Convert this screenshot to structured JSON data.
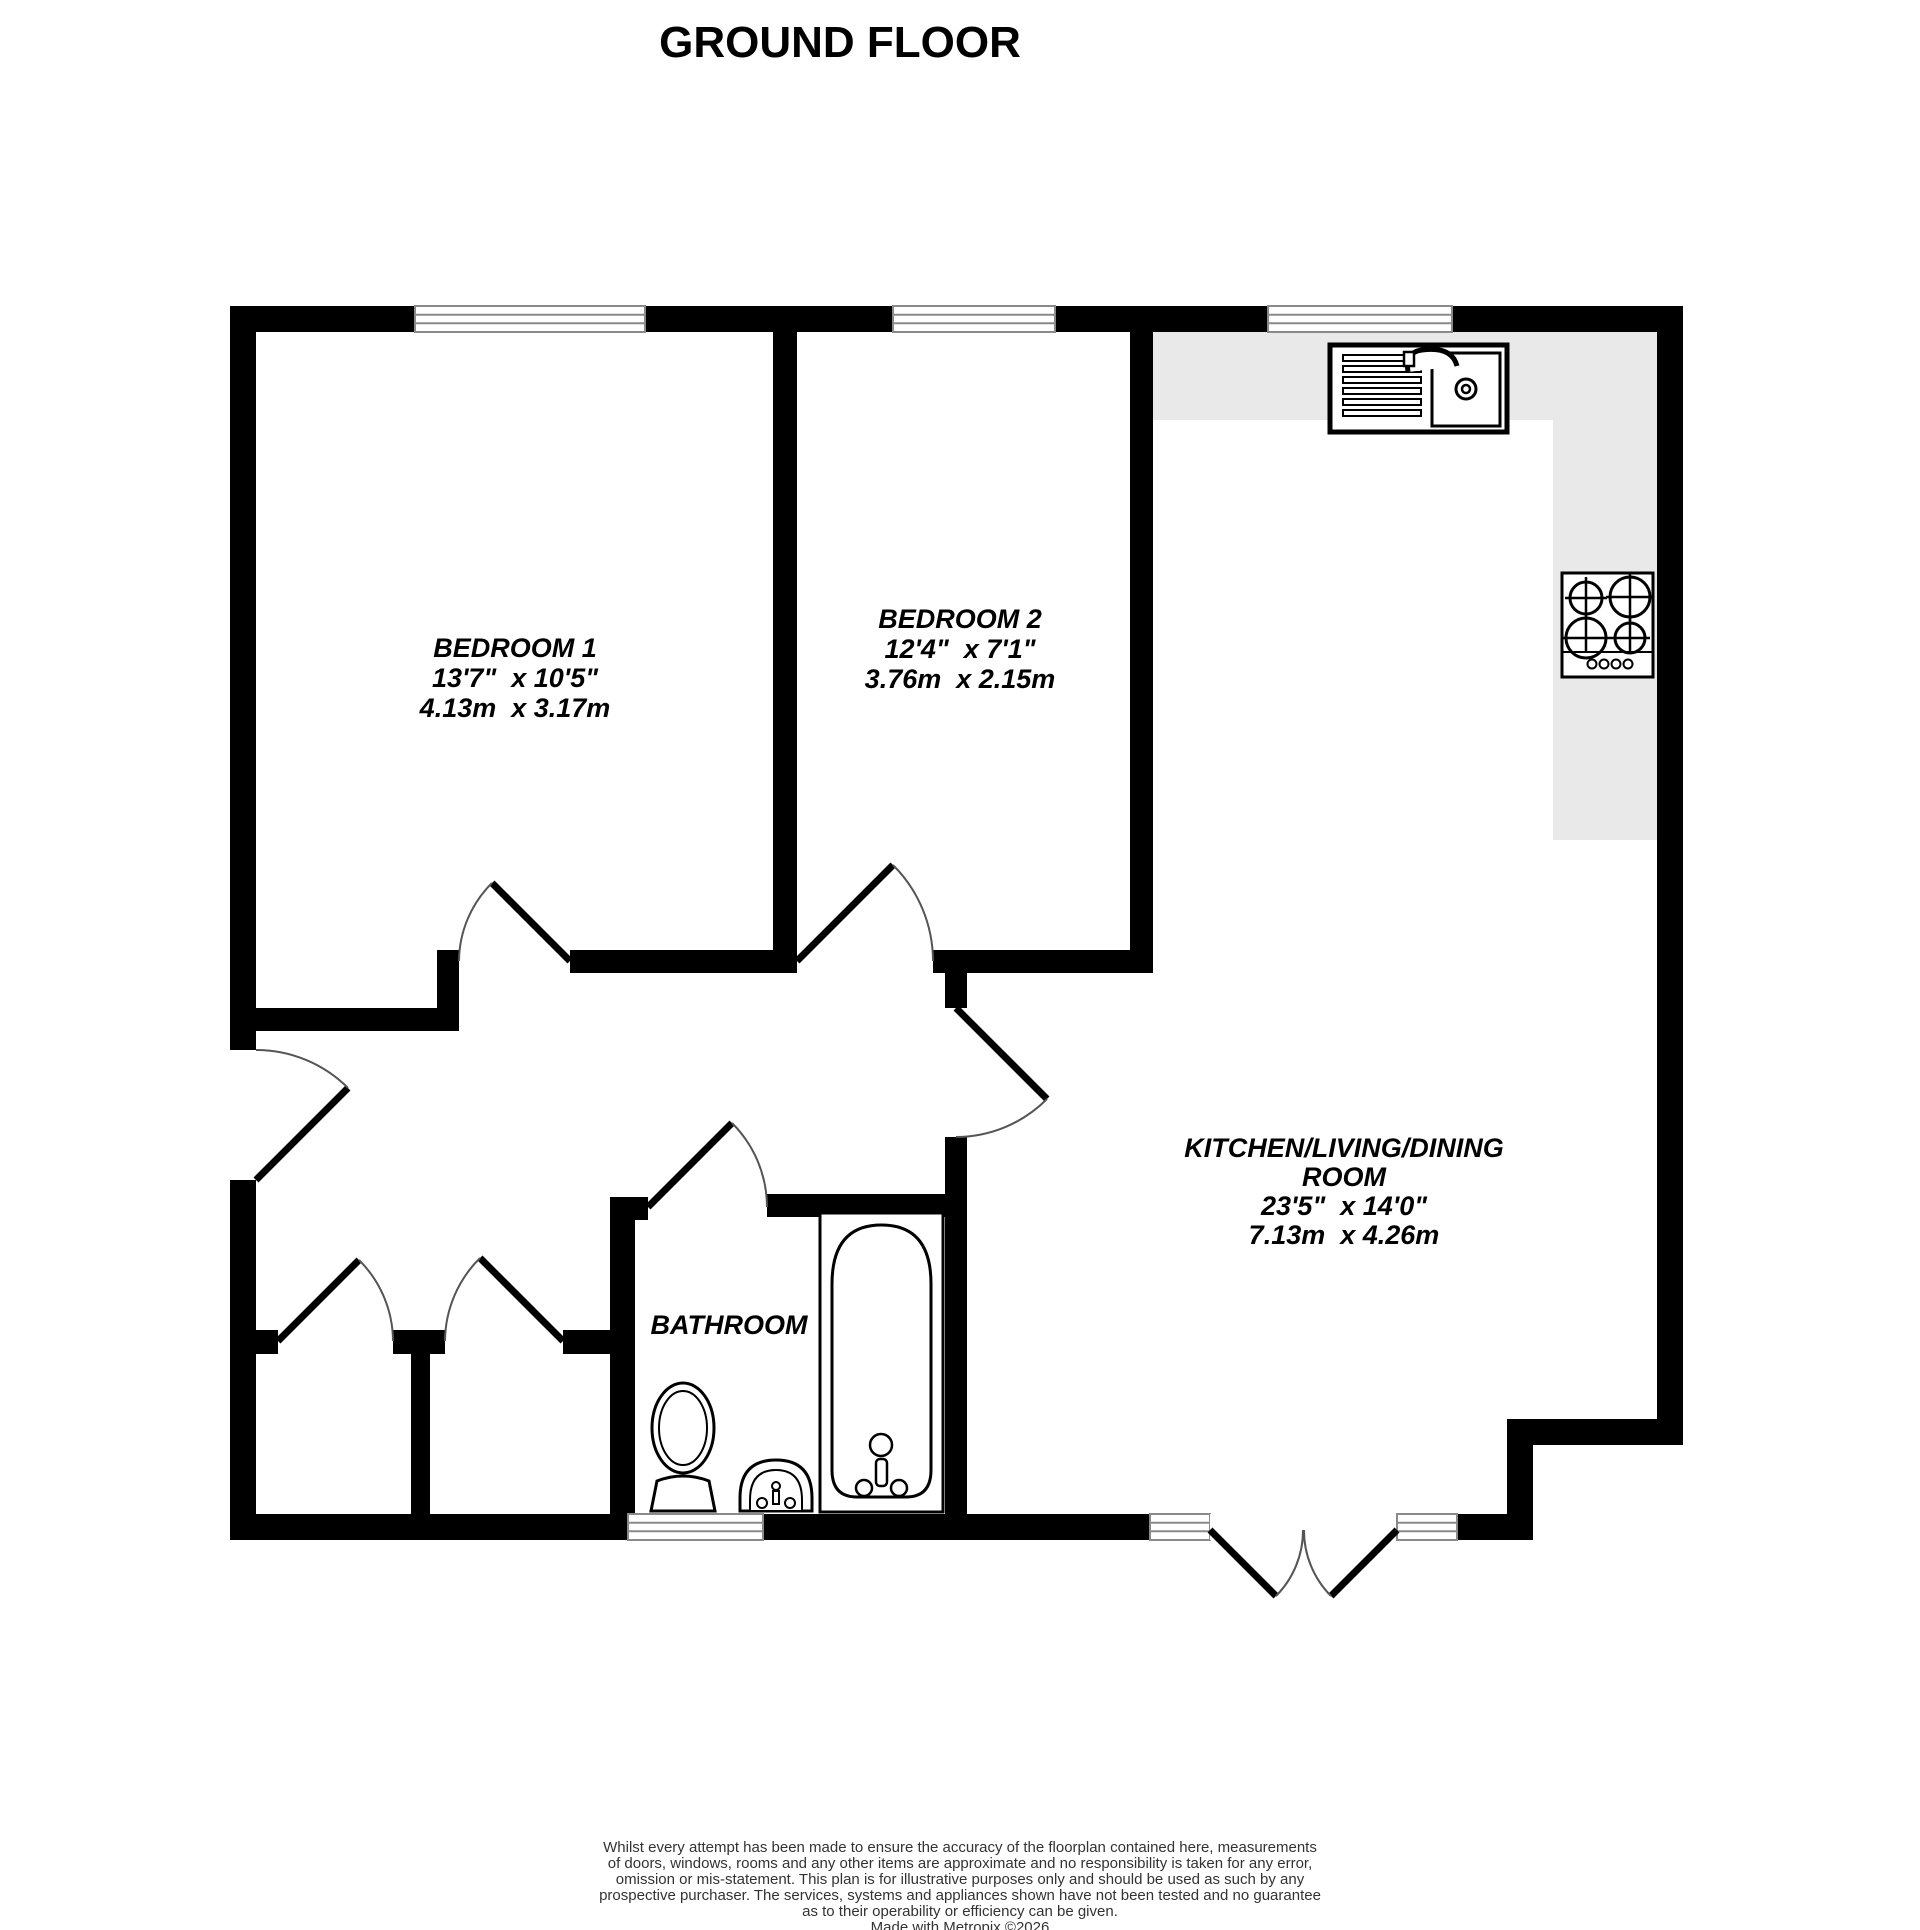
{
  "title": "GROUND FLOOR",
  "rooms": {
    "bedroom1": {
      "name": "BEDROOM 1",
      "size_imperial": "13'7\"  x 10'5\"",
      "size_metric": "4.13m  x 3.17m"
    },
    "bedroom2": {
      "name": "BEDROOM 2",
      "size_imperial": "12'4\"  x 7'1\"",
      "size_metric": "3.76m  x 2.15m"
    },
    "kitchen_living_dining": {
      "name_line1": "KITCHEN/LIVING/DINING",
      "name_line2": "ROOM",
      "size_imperial": "23'5\"  x 14'0\"",
      "size_metric": "7.13m  x 4.26m"
    },
    "bathroom": {
      "name": "BATHROOM"
    }
  },
  "fixtures": [
    "kitchen-sink-with-drainer",
    "four-burner-hob",
    "bathtub",
    "toilet",
    "wash-basin"
  ],
  "footer": {
    "disclaimer_lines": [
      "Whilst every attempt has been made to ensure the accuracy of the floorplan contained here, measurements",
      "of doors, windows, rooms and any other items are approximate and no responsibility is taken for any error,",
      "omission or mis-statement. This plan is for illustrative purposes only and should be used as such by any",
      "prospective purchaser. The services, systems and appliances shown have not been tested and no guarantee",
      "as to their operability or efficiency can be given."
    ],
    "credit": "Made with Metropix ©2026"
  },
  "colors": {
    "wall": "#000000",
    "counter": "#e9e9e9",
    "window_mullion": "#8a8a8a",
    "door_arc": "#555555",
    "background": "#ffffff",
    "disclaimer_text": "#333333"
  }
}
